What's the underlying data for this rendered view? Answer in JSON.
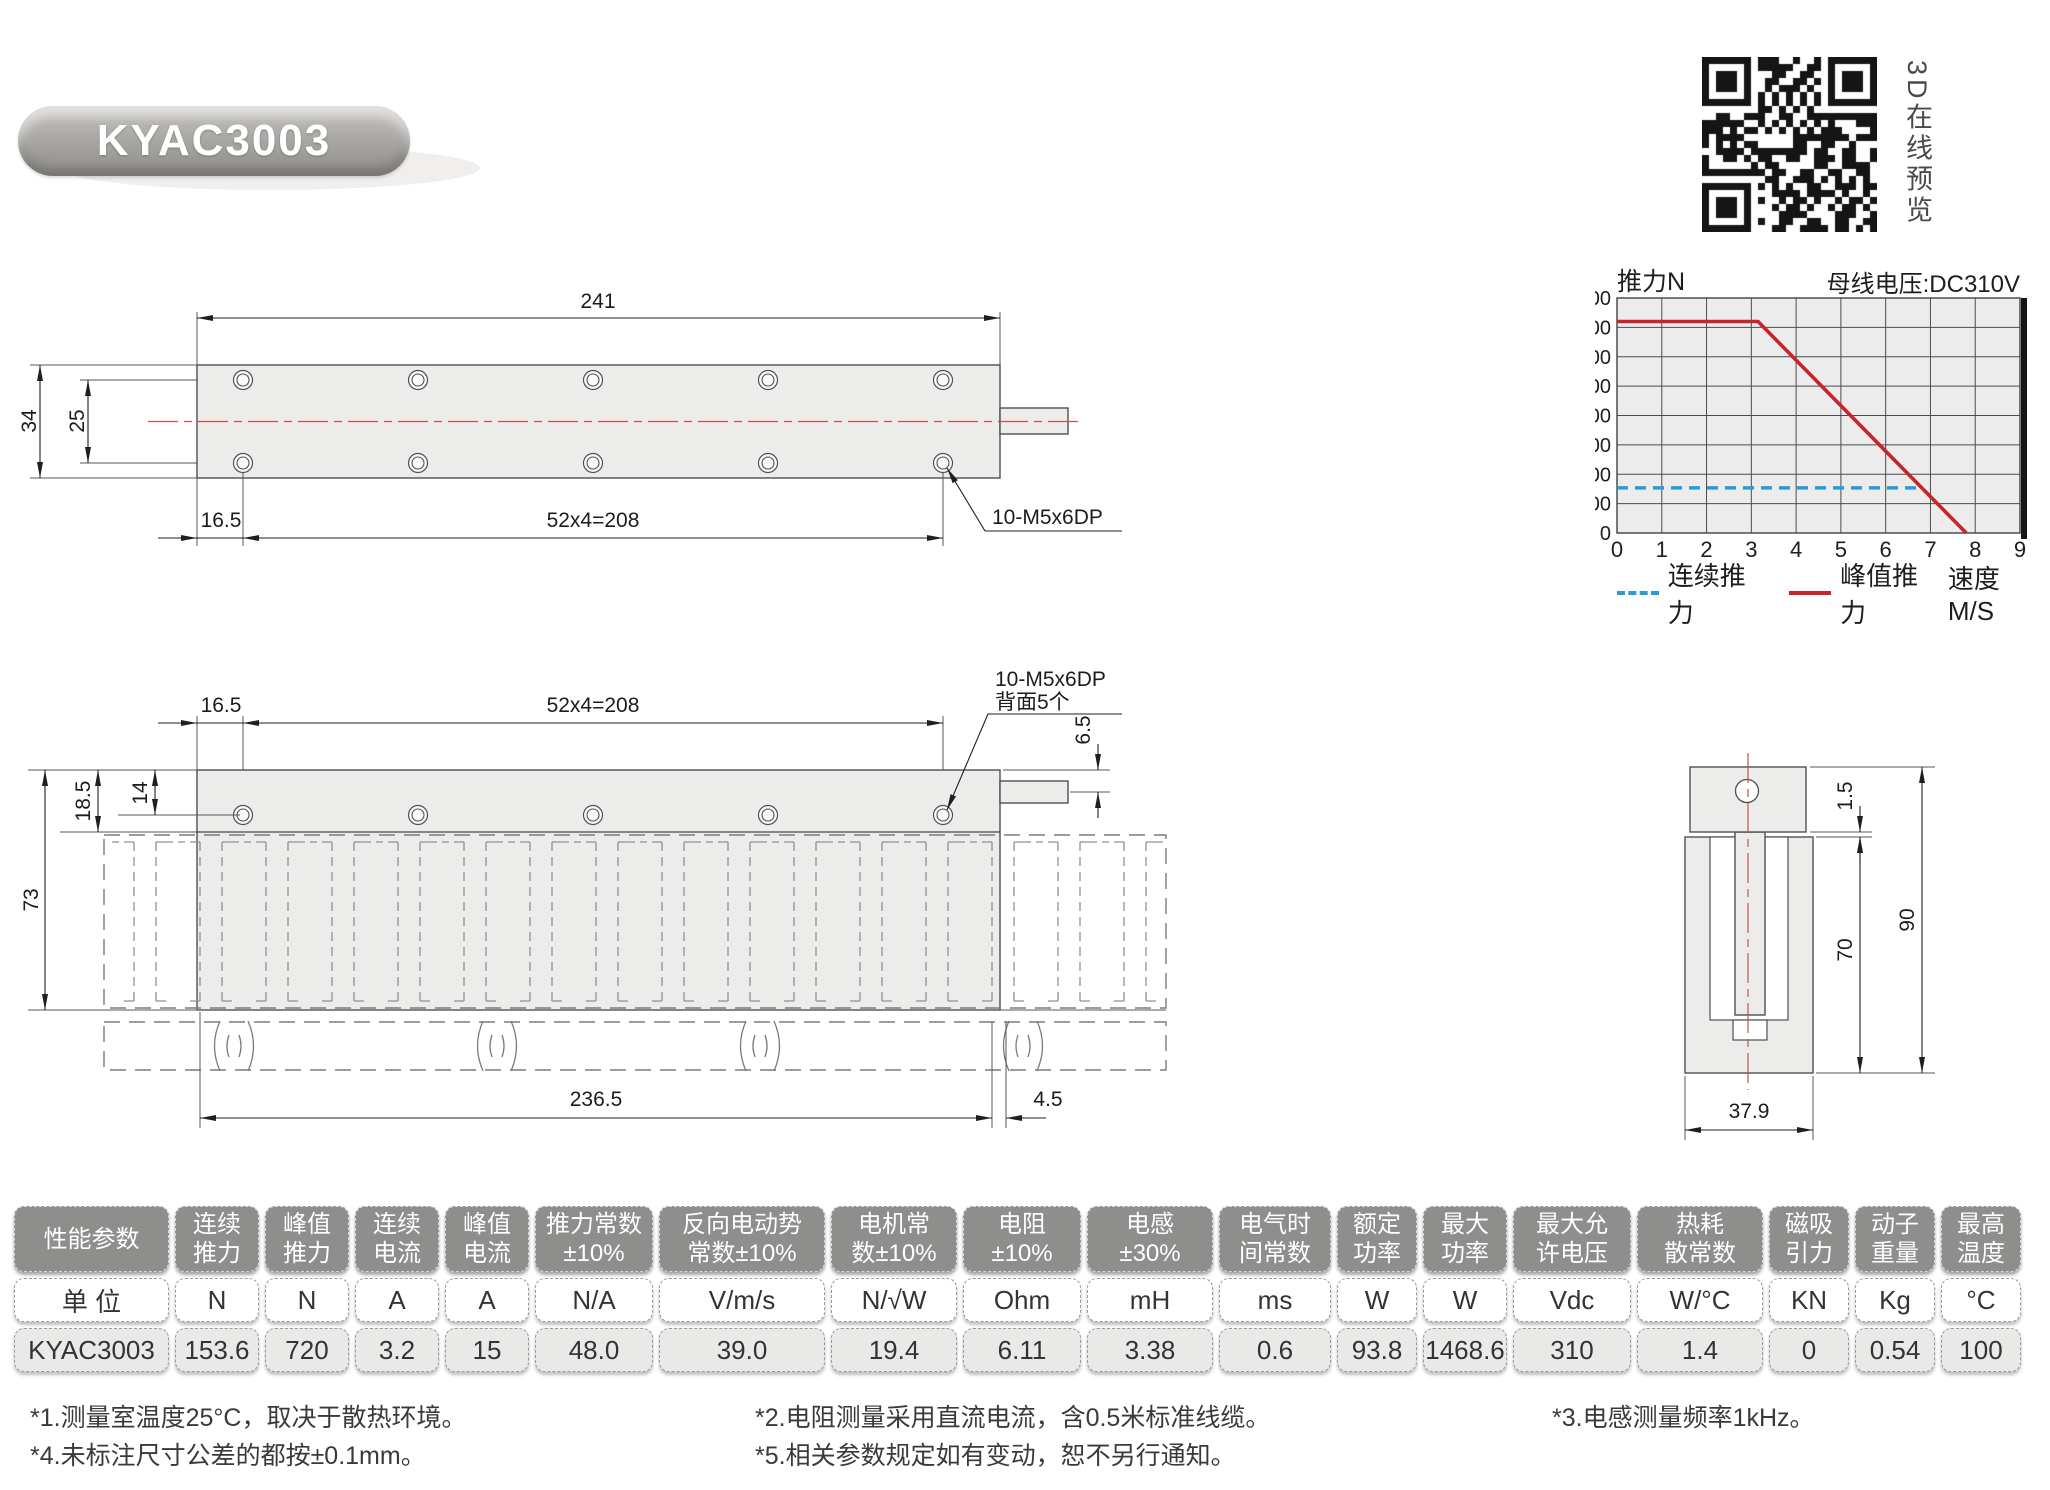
{
  "title": "KYAC3003",
  "qr": {
    "caption": "3D在线预览"
  },
  "chart_data": {
    "type": "line",
    "title": "推力N",
    "note": "母线电压:DC310V",
    "xlabel": "速度M/S",
    "ylabel": "推力N",
    "xlim": [
      0,
      9
    ],
    "ylim": [
      0,
      800
    ],
    "xticks": [
      0,
      1,
      2,
      3,
      4,
      5,
      6,
      7,
      8,
      9
    ],
    "yticks": [
      0,
      100,
      200,
      300,
      400,
      500,
      600,
      700,
      800
    ],
    "grid": true,
    "legend_position": "bottom",
    "plot_bg": "#ececec",
    "series": [
      {
        "name": "连续推力",
        "style": "dashed",
        "color": "#2d9bd3",
        "points": [
          [
            0,
            153.6
          ],
          [
            6.8,
            153.6
          ]
        ]
      },
      {
        "name": "峰值推力",
        "style": "solid",
        "color": "#c8242a",
        "points": [
          [
            0,
            720
          ],
          [
            3.15,
            720
          ],
          [
            7.8,
            0
          ]
        ]
      }
    ]
  },
  "drawings": {
    "top_view": {
      "dim_length": "241",
      "dim_height": "34",
      "dim_hole_span": "25",
      "dim_offset": "16.5",
      "dim_pitch": "52x4=208",
      "thread_callout": "10-M5x6DP"
    },
    "front_view": {
      "dim_offset": "16.5",
      "dim_pitch": "52x4=208",
      "thread_callout_line1": "10-M5x6DP",
      "thread_callout_line2": "背面5个",
      "dim_tab": "6.5",
      "dim_plate": "18.5",
      "dim_hole_row": "14",
      "dim_total_height": "73",
      "dim_stator_length": "236.5",
      "dim_end_gap": "4.5"
    },
    "section_view": {
      "dim_gap": "1.5",
      "dim_total_height": "90",
      "dim_stator_height": "70",
      "dim_width": "37.9"
    }
  },
  "table": {
    "columns": [
      {
        "header": "性能参数",
        "unit": "单 位",
        "value": "KYAC3003"
      },
      {
        "header": "连续\n推力",
        "unit": "N",
        "value": "153.6"
      },
      {
        "header": "峰值\n推力",
        "unit": "N",
        "value": "720"
      },
      {
        "header": "连续\n电流",
        "unit": "A",
        "value": "3.2"
      },
      {
        "header": "峰值\n电流",
        "unit": "A",
        "value": "15"
      },
      {
        "header": "推力常数\n±10%",
        "unit": "N/A",
        "value": "48.0"
      },
      {
        "header": "反向电动势\n常数±10%",
        "unit": "V/m/s",
        "value": "39.0"
      },
      {
        "header": "电机常\n数±10%",
        "unit": "N/√W",
        "value": "19.4"
      },
      {
        "header": "电阻\n±10%",
        "unit": "Ohm",
        "value": "6.11"
      },
      {
        "header": "电感\n±30%",
        "unit": "mH",
        "value": "3.38"
      },
      {
        "header": "电气时\n间常数",
        "unit": "ms",
        "value": "0.6"
      },
      {
        "header": "额定\n功率",
        "unit": "W",
        "value": "93.8"
      },
      {
        "header": "最大\n功率",
        "unit": "W",
        "value": "1468.6"
      },
      {
        "header": "最大允\n许电压",
        "unit": "Vdc",
        "value": "310"
      },
      {
        "header": "热耗\n散常数",
        "unit": "W/°C",
        "value": "1.4"
      },
      {
        "header": "磁吸\n引力",
        "unit": "KN",
        "value": "0"
      },
      {
        "header": "动子\n重量",
        "unit": "Kg",
        "value": "0.54"
      },
      {
        "header": "最高\n温度",
        "unit": "°C",
        "value": "100"
      }
    ]
  },
  "footnotes": {
    "note1": "*1.测量室温度25°C，取决于散热环境。",
    "note4": "*4.未标注尺寸公差的都按±0.1mm。",
    "note2": "*2.电阻测量采用直流电流，含0.5米标准线缆。",
    "note5": "*5.相关参数规定如有变动，恕不另行通知。",
    "note3": "*3.电感测量频率1kHz。"
  }
}
